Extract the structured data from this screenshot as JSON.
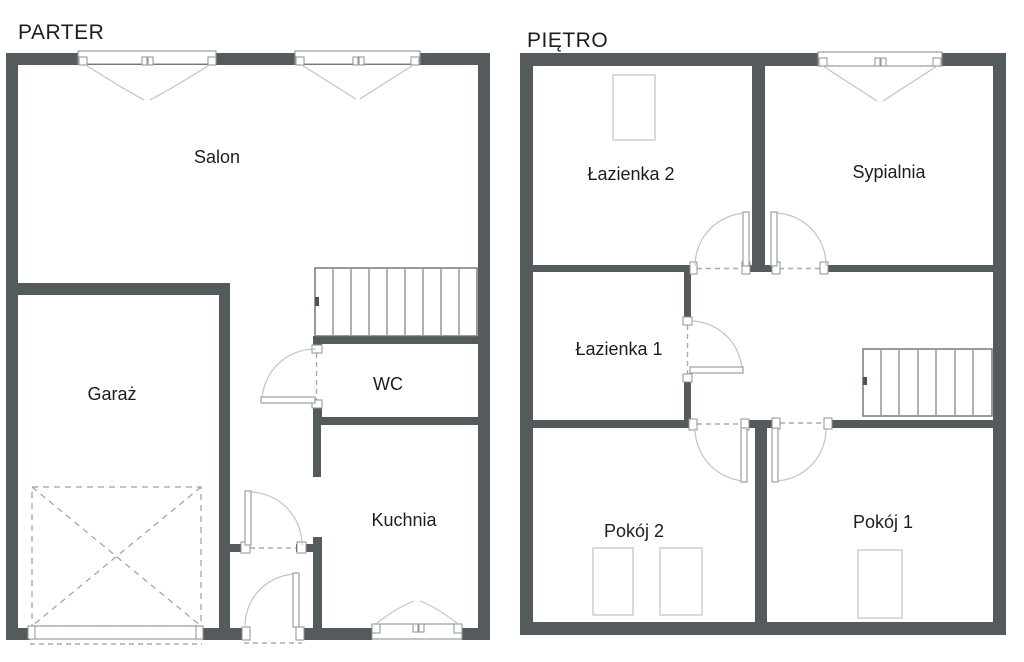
{
  "plans": {
    "parter": {
      "title": "PARTER",
      "rooms": {
        "salon": "Salon",
        "garaz": "Garaż",
        "wc": "WC",
        "kuchnia": "Kuchnia"
      }
    },
    "pietro": {
      "title": "PIĘTRO",
      "rooms": {
        "lazienka2": "Łazienka 2",
        "sypialnia": "Sypialnia",
        "lazienka1": "Łazienka 1",
        "pokoj2": "Pokój 2",
        "pokoj1": "Pokój 1"
      }
    }
  },
  "colors": {
    "wall": "#555a5d",
    "line": "#c0c4c6",
    "stairs": "#6b7073",
    "fixture": "#c4c8ca",
    "text": "#1d1d1f"
  }
}
